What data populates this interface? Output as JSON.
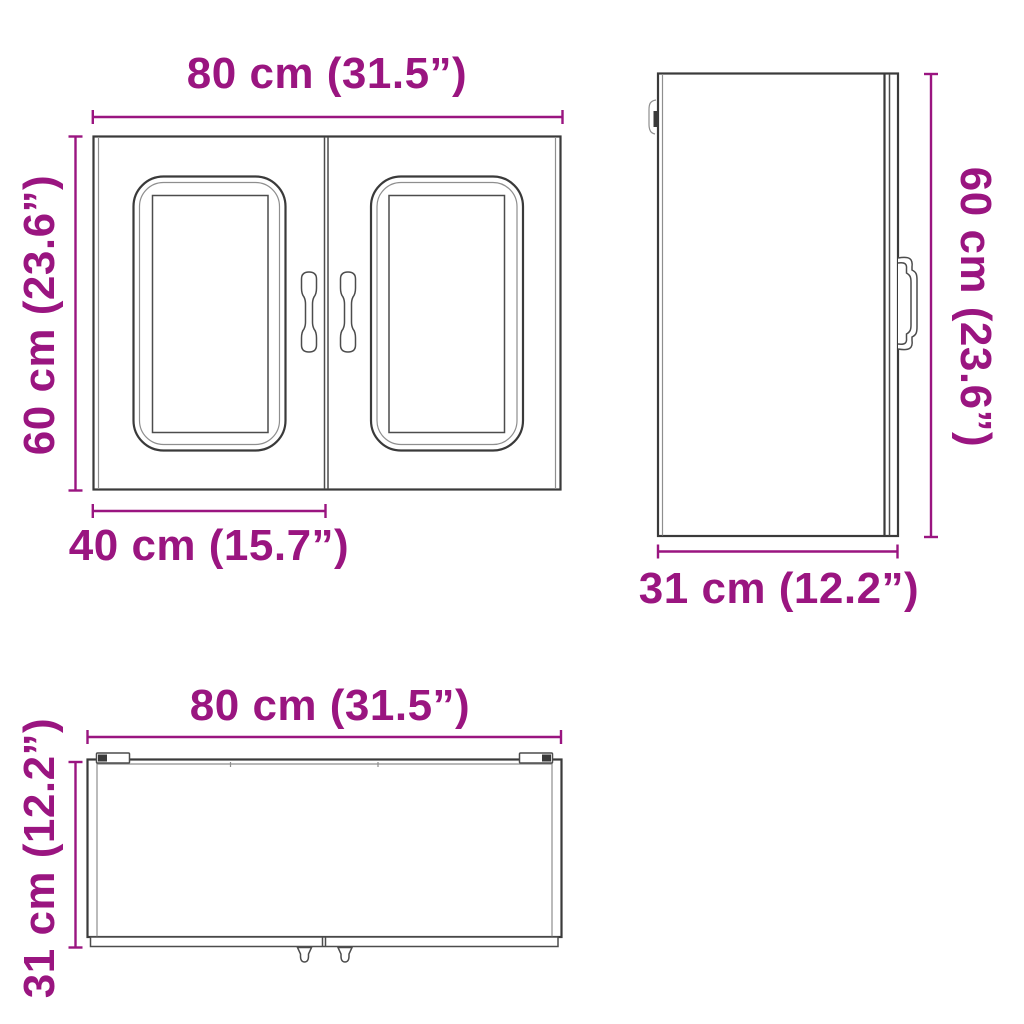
{
  "colors": {
    "accent": "#9A1580",
    "line": "#3A3A3A"
  },
  "views": {
    "front": {
      "width_label": "80 cm (31.5”)",
      "height_label": "60 cm (23.6”)",
      "door_width_label": "40 cm (15.7”)"
    },
    "side": {
      "height_label": "60 cm (23.6”)",
      "depth_label": "31 cm (12.2”)"
    },
    "bottom": {
      "width_label": "80 cm (31.5”)",
      "depth_label": "31 cm (12.2”)"
    }
  }
}
